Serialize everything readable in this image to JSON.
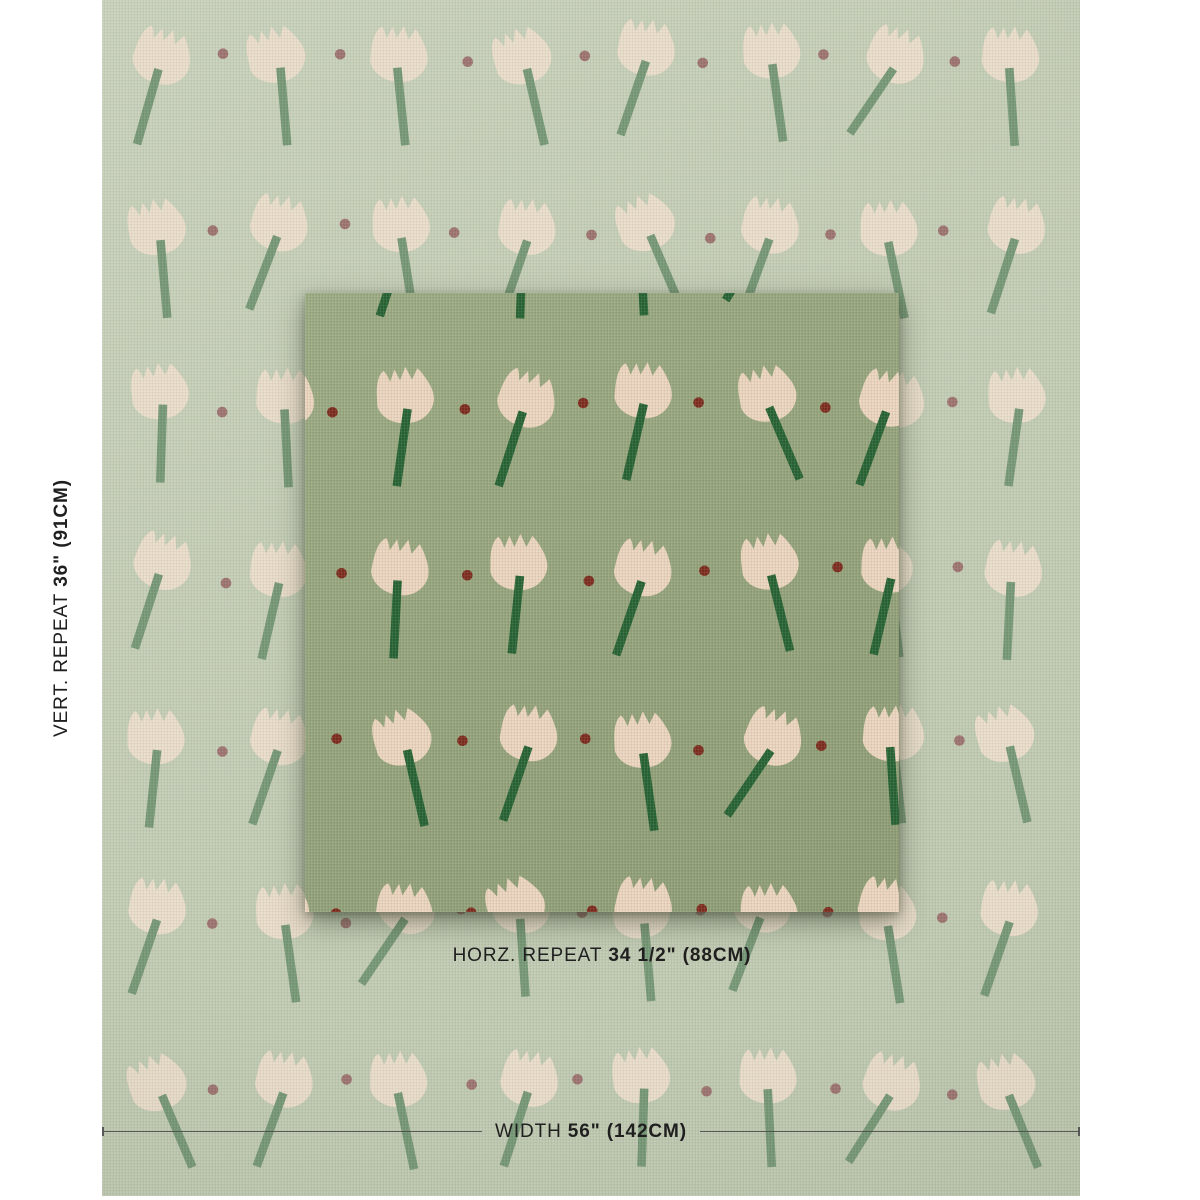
{
  "labels": {
    "vert": {
      "regular": "VERT. REPEAT",
      "bold": "36\" (91CM)"
    },
    "horz": {
      "regular": "HORZ. REPEAT",
      "bold": "34 1/2\" (88CM)"
    },
    "width": {
      "regular": "WIDTH",
      "bold": "56\" (142CM)"
    }
  },
  "colors": {
    "page_bg": "#ffffff",
    "text": "#1f1f1f",
    "measure_line": "#4a4a4a"
  },
  "fabric": {
    "left": 102,
    "top": 0,
    "width": 978,
    "height": 1196,
    "bg": "#c4cdb6",
    "bg_light": "#c9d2bc",
    "bg_dark": "#bec8b0"
  },
  "closeup": {
    "left": 305,
    "top": 293,
    "width": 594,
    "height": 619,
    "bg": "#96a47d",
    "bg_light": "#9cab83",
    "bg_dark": "#8e9c75"
  },
  "pattern": {
    "grid": {
      "x0": 56,
      "dx": 122,
      "y0": 22,
      "dy": 171,
      "cols": 8,
      "rows": 7,
      "dot_dy": 40,
      "dot_r": 5.3,
      "head_angles": [
        14,
        -7,
        2,
        19,
        -13,
        6,
        -17,
        10,
        -3,
        21,
        5,
        -11,
        16,
        -2,
        8,
        -20,
        12,
        0
      ],
      "stem_angles": [
        5,
        -7,
        11,
        -3,
        8,
        -12,
        4,
        9,
        -5,
        13,
        -9,
        6
      ]
    },
    "outer": {
      "tulip": "#eaddca",
      "stem": "#769876",
      "dot": "#9d7370",
      "seed": 3
    },
    "inner": {
      "tulip": "#ecd5bf",
      "stem": "#266233",
      "dot": "#7c2b1d",
      "seed": 8
    }
  }
}
